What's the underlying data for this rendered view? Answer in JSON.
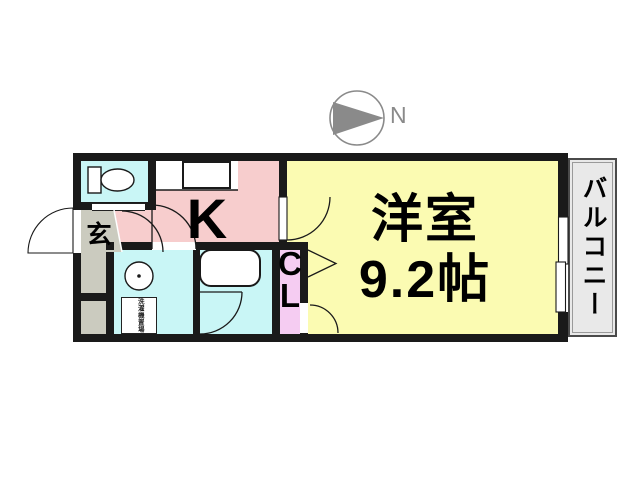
{
  "compass": {
    "north_label": "N"
  },
  "plan": {
    "main_room": {
      "name": "洋室",
      "size": "9.2帖"
    },
    "kitchen": {
      "label": "K"
    },
    "entrance": {
      "label": "玄"
    },
    "closet": {
      "line1": "C",
      "line2": "L"
    },
    "balcony": {
      "label": "バルコニー"
    },
    "laundry": {
      "label": "洗濯機置場"
    }
  },
  "colors": {
    "wall": "#1a1a1a",
    "room-yellow": "#fbfbb2",
    "kitchen-pink": "#f7cdcd",
    "water-cyan": "#c9f6f6",
    "closet-plum": "#f5ccf2",
    "entrance-gray": "#cbcbbf",
    "balcony-gray": "#e9e9e9",
    "compass-gray": "#8a8a8a"
  }
}
